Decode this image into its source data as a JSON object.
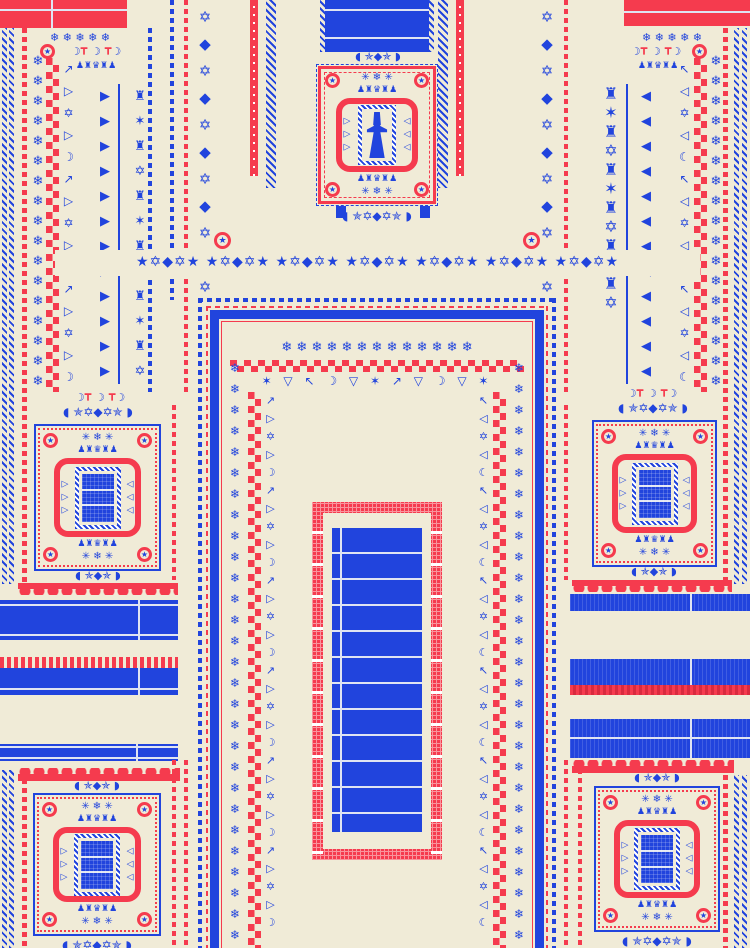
{
  "palette": {
    "cream": "#f0ebd7",
    "blue": "#2144dd",
    "red": "#f53b4e",
    "pink": "#f9949c",
    "line": "#dfe4f2"
  },
  "glyphs": {
    "star": "★",
    "snowflake": "❄",
    "snow3": "✳ ❄ ✳",
    "invaders": "♟♜♛♜♟",
    "orn": "◖ ✯✡◆✡✯ ◗",
    "orn_small": "◖ ✯◆✯ ◗",
    "band_unit": "★✡◆✡★",
    "stardia": "✡\n◆",
    "chain_motifs_l": "↗\n▷\n✡\n▷\n☽",
    "chain_motifs_r": "↖\n◁\n✡\n◁\n☾",
    "arrow_right": "▶",
    "arrow_left": "◀",
    "invader_col": "♜\n✶\n♜\n✡",
    "crescents": "☽   ☽   ☽",
    "tridents": "┳     ┳",
    "meander_row": "✶ ▽ ↖ ☽ ▽ ✶ ↗ ▽ ☽ ▽ ✶",
    "rug_mot_l": "▷\n▷\n▷",
    "rug_mot_r": "◁\n◁\n◁"
  }
}
